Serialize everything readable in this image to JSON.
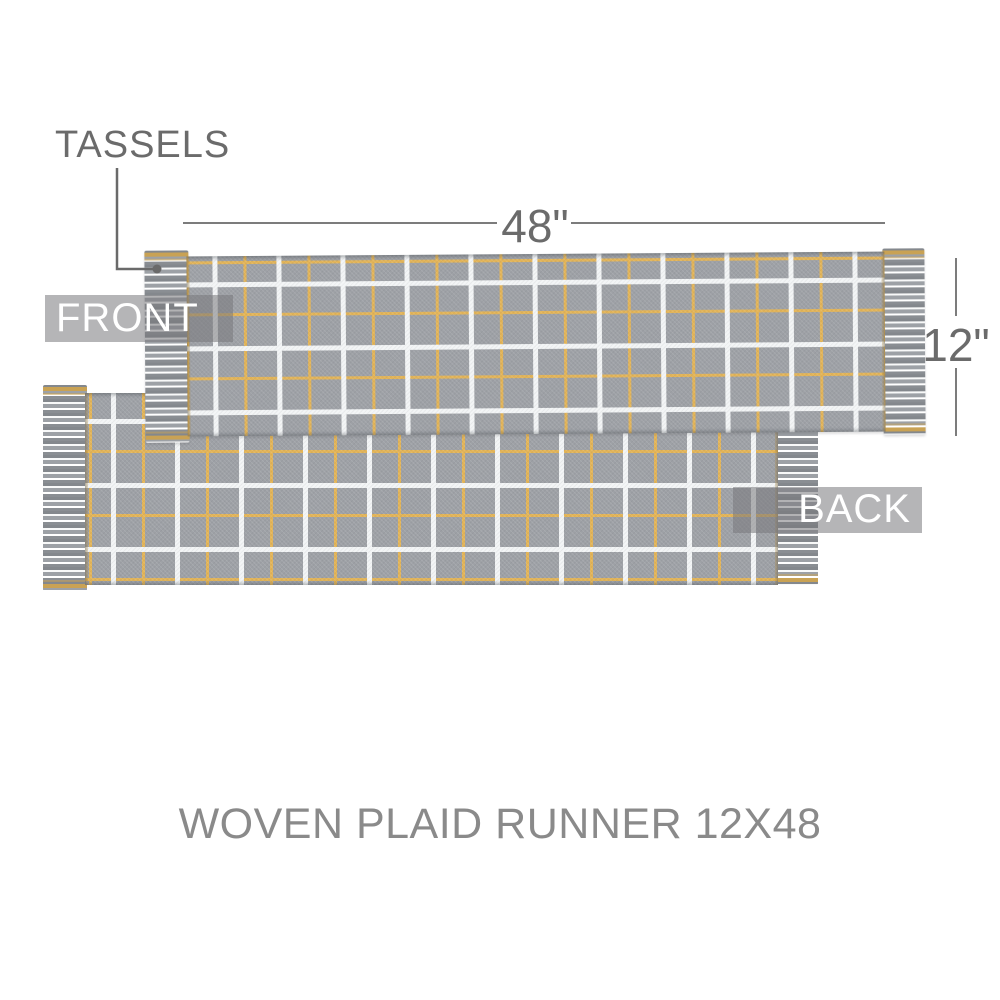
{
  "diagram": {
    "tassels_label": "TASSELS",
    "width_dimension": "48\"",
    "height_dimension": "12\"",
    "front_badge": "FRONT",
    "back_badge": "BACK",
    "title": "WOVEN PLAID RUNNER 12X48"
  },
  "colors": {
    "background": "#ffffff",
    "fabric_base": "#9ea1a6",
    "stripe_white": "#f3f5f6",
    "stripe_gold": "#e3b457",
    "tassel_dark": "#84888d",
    "tassel_mid": "#9da1a6",
    "tassel_light": "#f8f9f9",
    "tassel_gold": "#c9a254",
    "badge_bg": "rgba(120,121,124,0.55)",
    "badge_text": "#ffffff",
    "annotation_text": "#6b6b6b",
    "dim_line": "#7c7c7c",
    "title_text": "#8a8a8a"
  }
}
